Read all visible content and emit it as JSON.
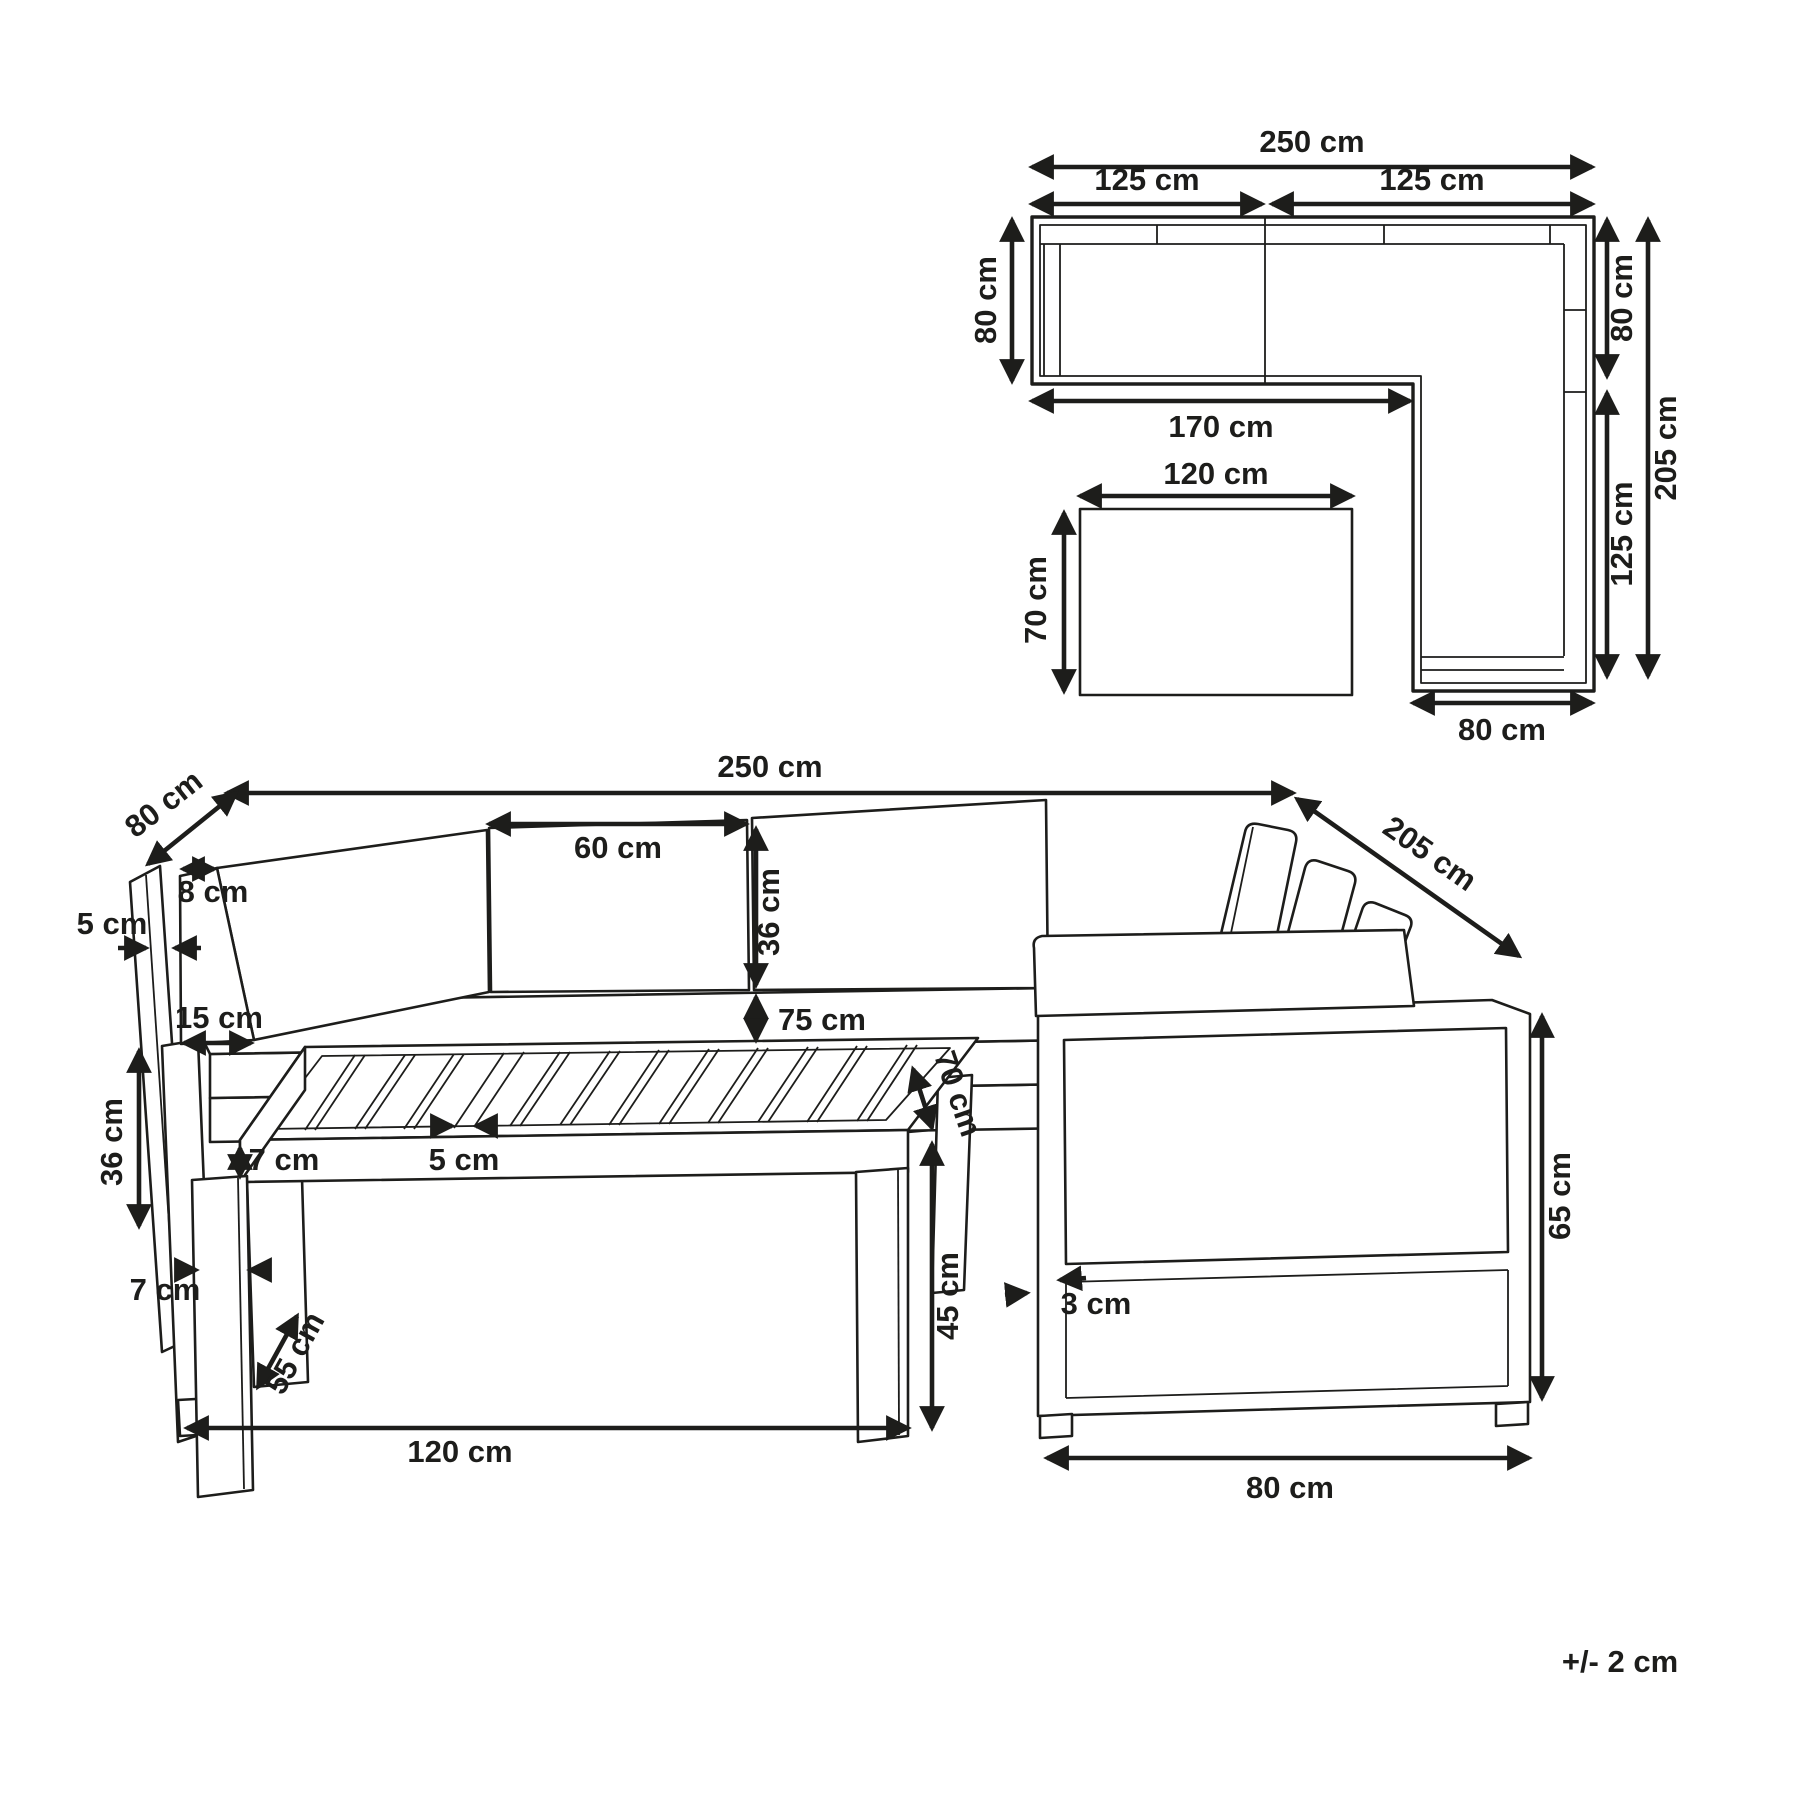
{
  "note": "+/- 2 cm",
  "unit": "cm",
  "colors": {
    "line": "#1d1d1b",
    "background": "#ffffff"
  },
  "plan": {
    "total_width": "250 cm",
    "left_module": "125 cm",
    "right_module": "125 cm",
    "left_depth": "80 cm",
    "bottom_width": "170 cm",
    "table_length": "120 cm",
    "table_depth": "70 cm",
    "right_depth": "80 cm",
    "right_length_total": "205 cm",
    "right_length_lower": "125 cm",
    "right_end_width": "80 cm"
  },
  "persp": {
    "total_width": "250 cm",
    "side_depth": "80 cm",
    "right_length": "205 cm",
    "cushion_width": "60 cm",
    "cushion_height": "36 cm",
    "cushion_top": "8 cm",
    "panel_thickness": "5 cm",
    "cushion_bottom": "15 cm",
    "seat_height": "75 cm",
    "frame_height": "36 cm",
    "top_thickness": "7 cm",
    "slat_gap": "5 cm",
    "leg_width": "7 cm",
    "leg_depth": "55 cm",
    "table_length": "120 cm",
    "table_height": "45 cm",
    "table_depth": "70 cm",
    "profile": "3 cm",
    "section_width": "80 cm",
    "side_height": "65 cm"
  }
}
